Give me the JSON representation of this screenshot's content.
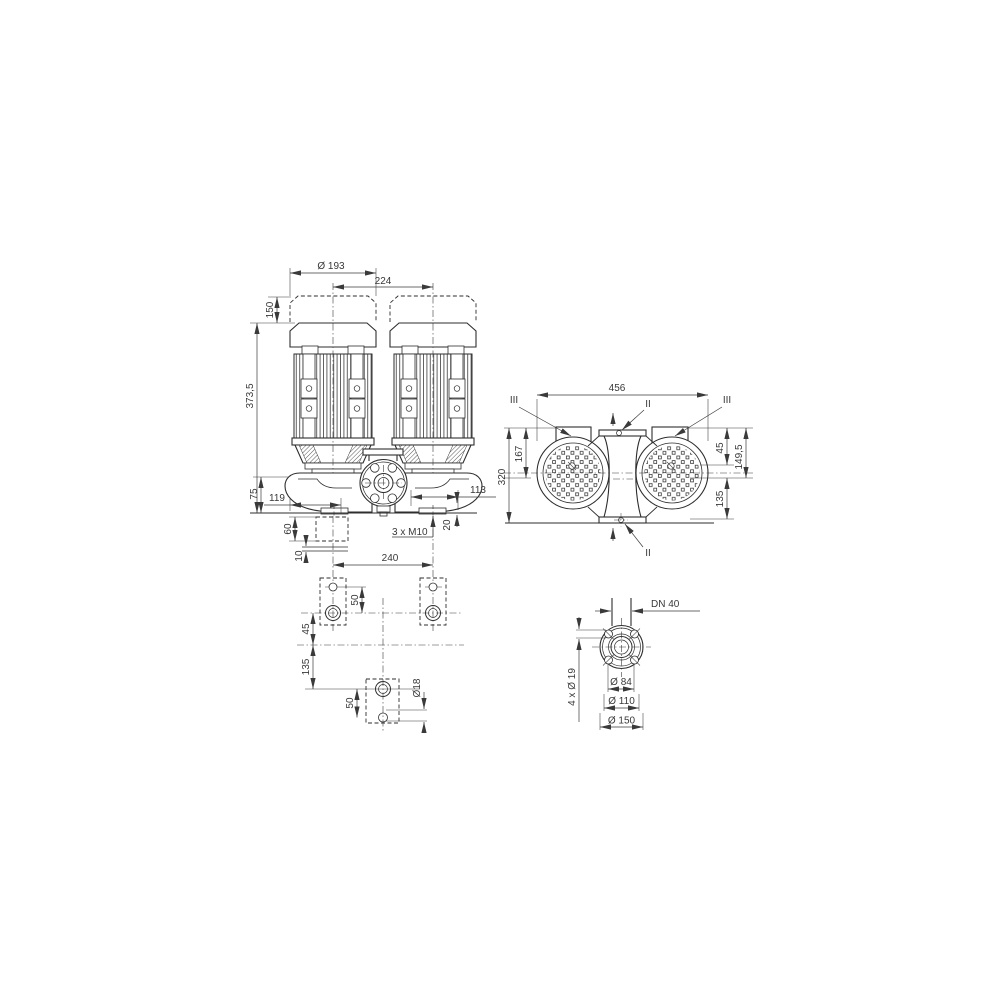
{
  "colors": {
    "line": "#2e2e2e",
    "text": "#383838",
    "background": "#ffffff"
  },
  "views": {
    "front": {
      "dims": {
        "motor_diameter": "Ø 193",
        "pump_spacing": "224",
        "removal_space": "150",
        "total_height": "373,5",
        "base_height": "75",
        "foot_left": "119",
        "block_height": "60",
        "grout_thickness": "10",
        "foot_right": "113",
        "foot_thickness": "20",
        "tapped_holes": "3 x M10",
        "anchor_spacing": "240"
      }
    },
    "side": {
      "dims": {
        "overall_width": "456",
        "overall_height": "320",
        "top_to_axis": "167",
        "axis_offset": "45",
        "flange_height": "149,5",
        "axis_to_base": "135"
      },
      "sections": {
        "ii": "II",
        "iii": "III"
      }
    },
    "plan": {
      "dims": {
        "hole_pitch_top": "50",
        "hole_to_axis": "45",
        "axis_to_hole": "135",
        "hole_pitch_bottom": "50",
        "hole_diameter": "Ø18"
      }
    },
    "flange": {
      "dims": {
        "nominal": "DN 40",
        "bolt_holes": "4 x Ø 19",
        "raised_face": "Ø 84",
        "bolt_circle": "Ø 110",
        "outer_diameter": "Ø 150"
      }
    }
  }
}
